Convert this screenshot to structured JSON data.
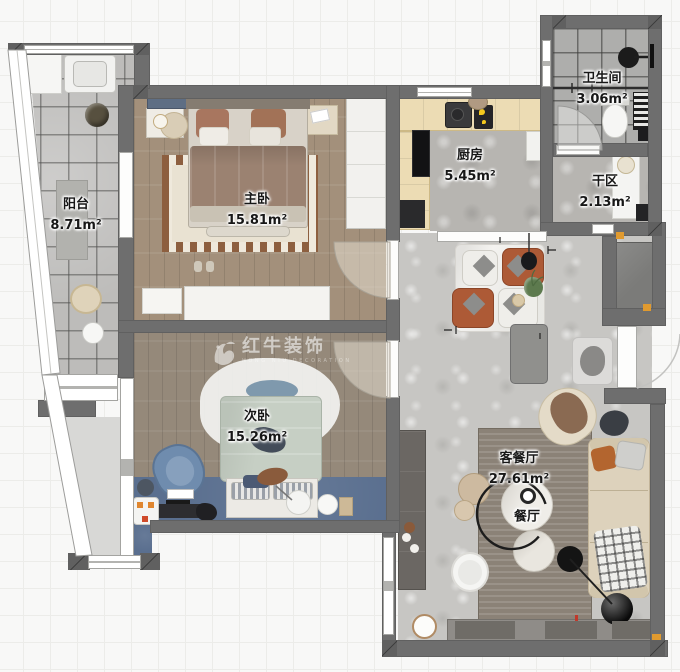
{
  "watermark": {
    "brand": "红牛装饰",
    "subtitle": "HONG NIU DECORATION"
  },
  "rooms": [
    {
      "id": "balcony",
      "name": "阳台",
      "area": "8.71m²"
    },
    {
      "id": "master",
      "name": "主卧",
      "area": "15.81m²"
    },
    {
      "id": "kitchen",
      "name": "厨房",
      "area": "5.45m²"
    },
    {
      "id": "bathroom",
      "name": "卫生间",
      "area": "3.06m²"
    },
    {
      "id": "dry-area",
      "name": "干区",
      "area": "2.13m²"
    },
    {
      "id": "second",
      "name": "次卧",
      "area": "15.26m²"
    },
    {
      "id": "living",
      "name": "客餐厅",
      "area": "27.61m²"
    },
    {
      "id": "dining",
      "name": "餐厅",
      "area": ""
    }
  ],
  "colors": {
    "wall": "#6e6e6e",
    "wood_master": "#a3907b",
    "wood_second": "#95897a",
    "balcony_tile": "#bdbcba",
    "bath_tile": "#aeaeac",
    "living_floor": "#c7c6c3",
    "desk_blue": "#5a6f8f",
    "chair_rust": "#ad5a36",
    "duvet_sage": "#c6cfc4",
    "sofa_beige": "#ddd2bc",
    "entry_niche": "#7b7b79",
    "marker_orange": "#e09a2f"
  }
}
